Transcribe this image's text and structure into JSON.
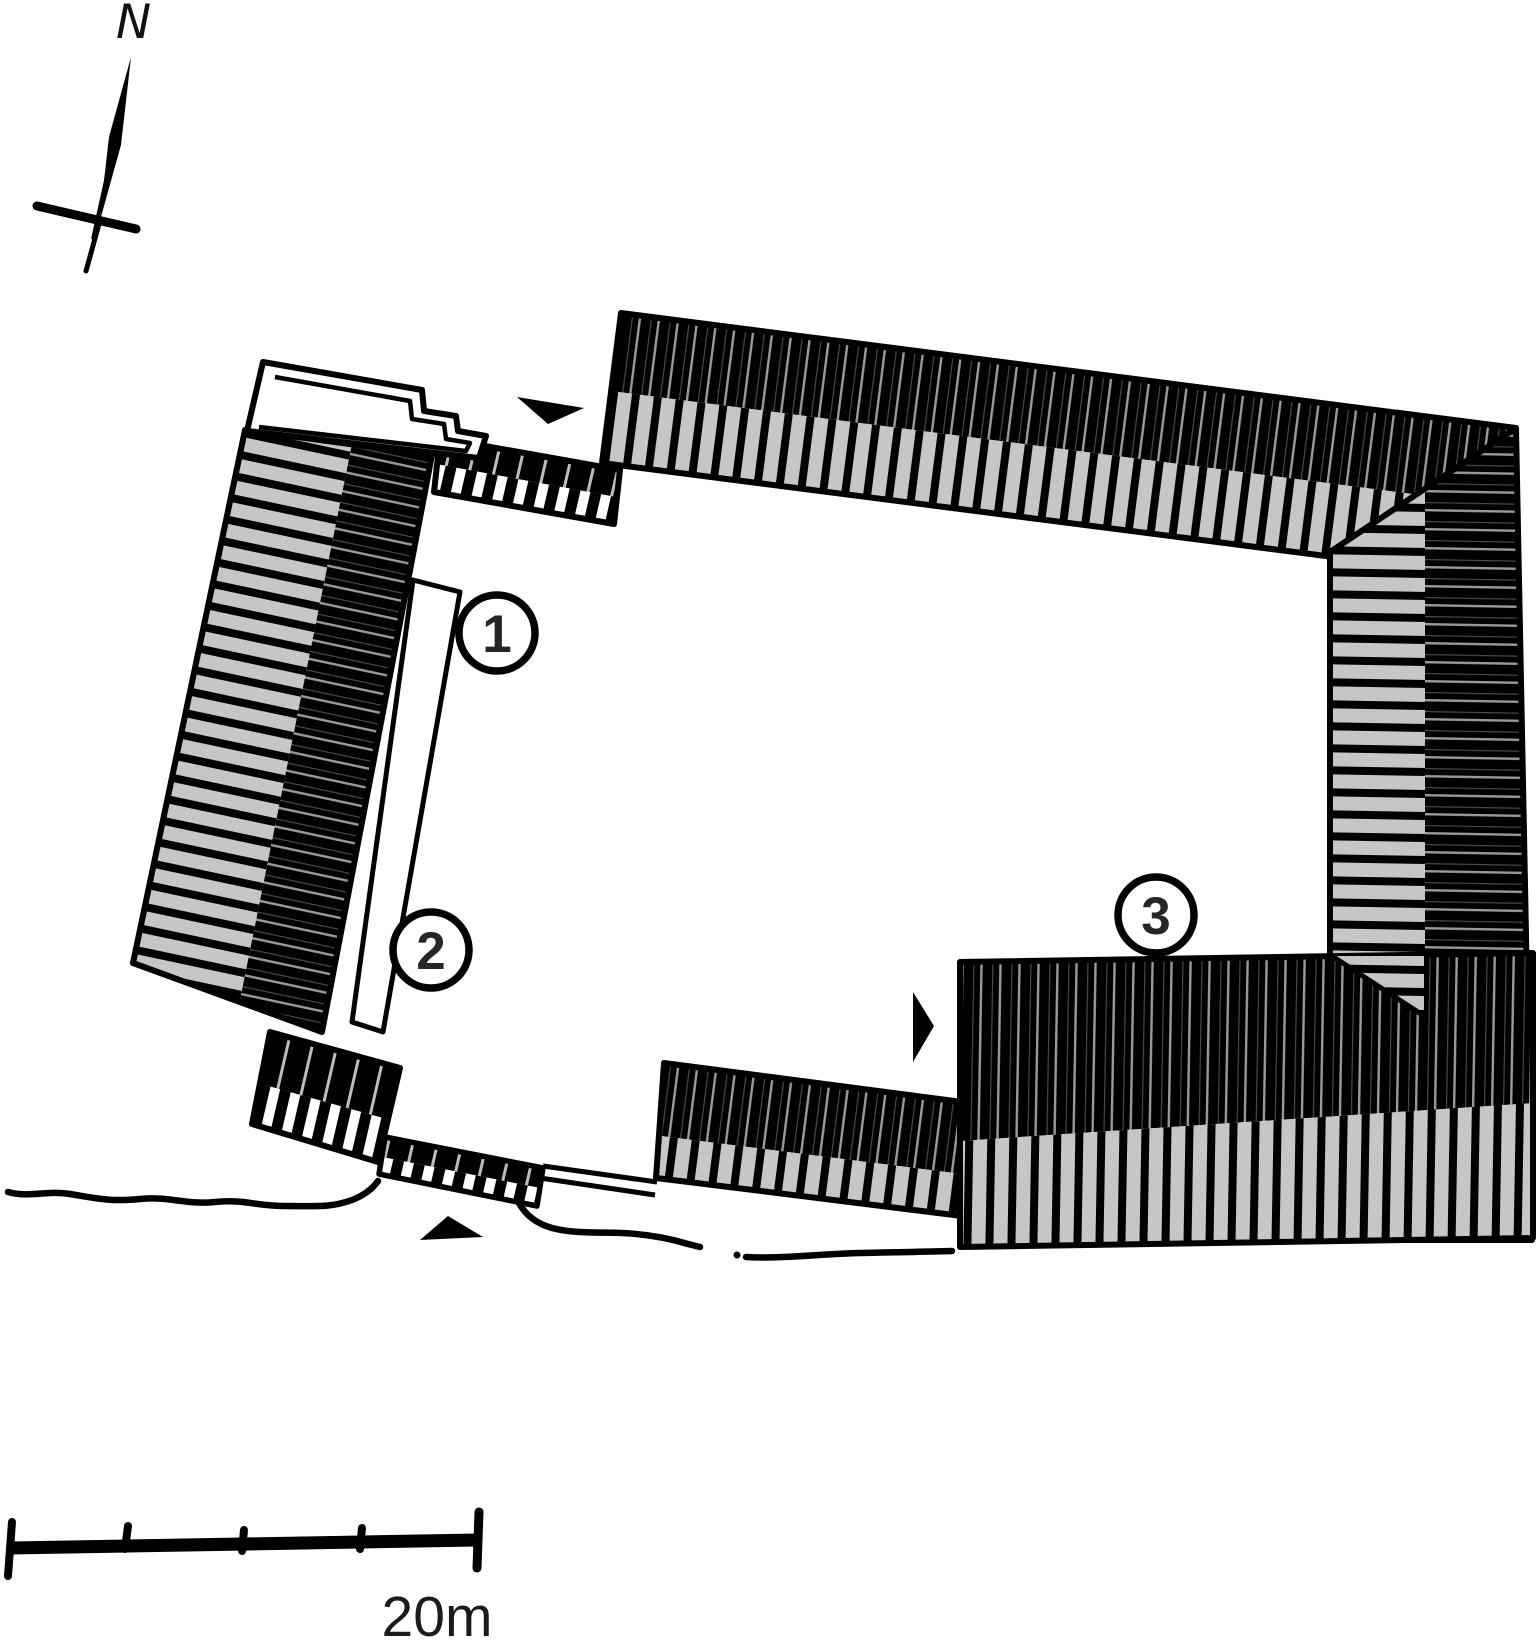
{
  "figure": {
    "compass": {
      "label": "N"
    },
    "scale_bar": {
      "label": "20m",
      "segments": 4
    },
    "markers": [
      {
        "label": "1"
      },
      {
        "label": "2"
      },
      {
        "label": "3"
      }
    ],
    "colors": {
      "ink": "#000000",
      "roof_gray": "#c6c6c6",
      "paper": "#ffffff",
      "text": "#1a1a1a"
    }
  }
}
